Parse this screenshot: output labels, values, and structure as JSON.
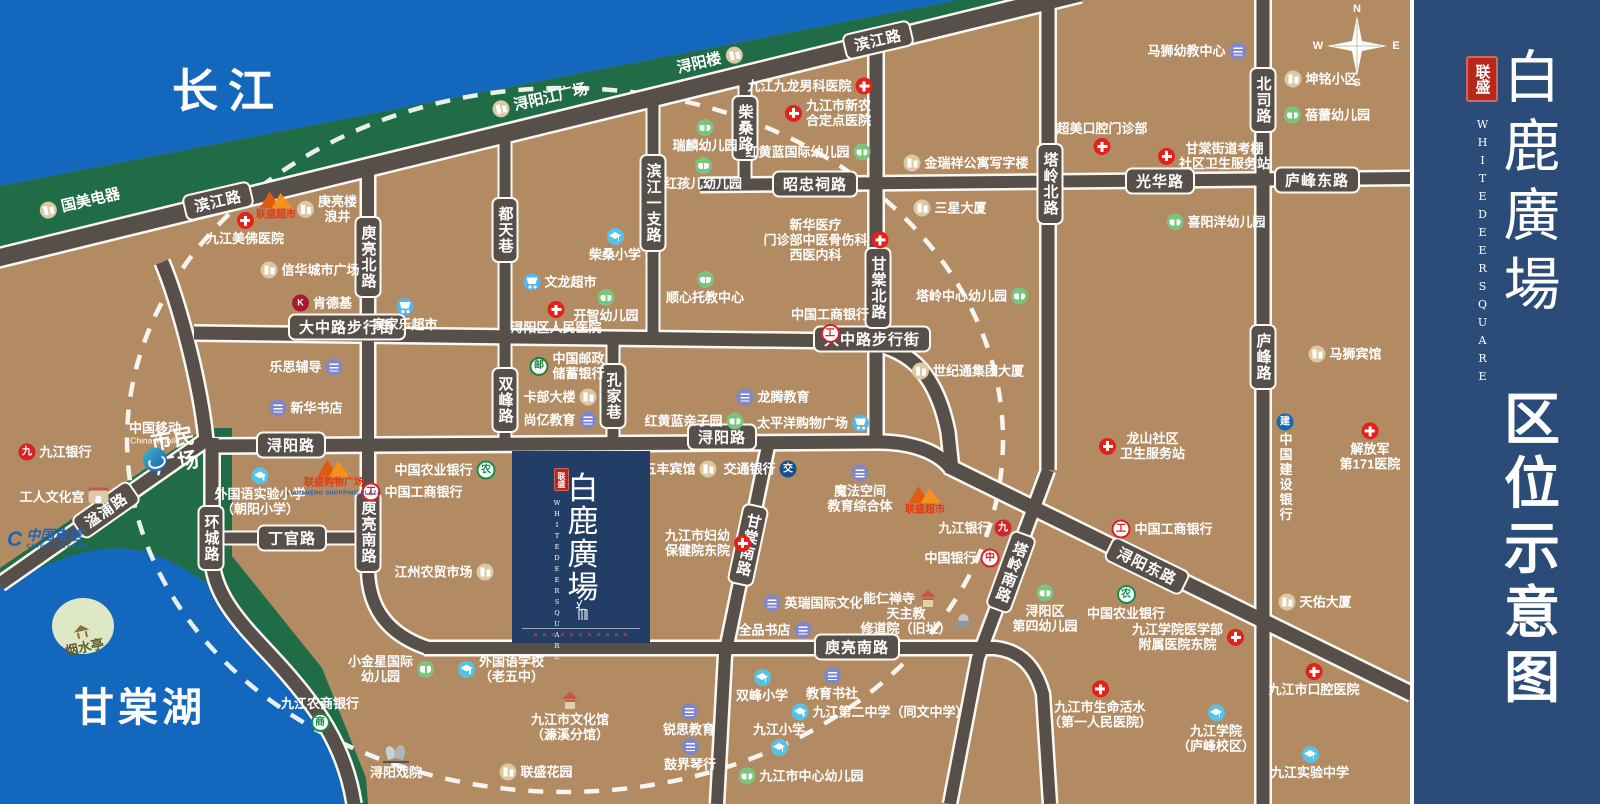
{
  "banner": {
    "seal": "联盛",
    "title": "白鹿廣場",
    "subtitle": "WHITEDEERSQUARE",
    "caption": "区位示意图"
  },
  "project": {
    "seal": "联盛",
    "title": "白鹿廣場",
    "subtitle": "WHITEDEERSQUARE"
  },
  "areas": {
    "river": "长江",
    "lake": "甘棠湖",
    "plaza_l1": "市民",
    "plaza_l2": "广场"
  },
  "compass": {
    "n": "N",
    "e": "E",
    "s": "S",
    "w": "W"
  },
  "colors": {
    "land": "#B38B63",
    "water": "#1367BC",
    "green": "#1F6C46",
    "road": "#57504A",
    "banner": "#2B4B78",
    "block": "#233E66",
    "seal_red": "#B6281C",
    "hospital": "#E32119",
    "school": "#55C3E8",
    "kindergarten": "#79C57E",
    "education": "#7E87CC",
    "market": "#57B6E9",
    "building": "#DBC9A3"
  },
  "icon_glyphs": {
    "icbc": "工",
    "boc": "中",
    "abc": "农",
    "psbc": "邮",
    "rcb": "商",
    "jjb": "九",
    "bocom": "交",
    "ccb": "建",
    "kfc": "K"
  },
  "band_labels": [
    {
      "t": "国美电器",
      "x": 80,
      "y": 203,
      "icon": "bldg",
      "side": "left",
      "rot": -13
    },
    {
      "t": "浔阳江广场",
      "x": 540,
      "y": 100,
      "icon": "bldg",
      "side": "left",
      "rot": -13
    },
    {
      "t": "浔阳楼",
      "x": 710,
      "y": 61,
      "icon": "bldg",
      "side": "right",
      "rot": -13
    }
  ],
  "road_labels": [
    {
      "t": "滨江路",
      "x": 218,
      "y": 201,
      "rot": -13
    },
    {
      "t": "滨江路",
      "x": 878,
      "y": 40,
      "rot": -13
    },
    {
      "t": "大中路步行街",
      "x": 347,
      "y": 327
    },
    {
      "t": "大中路步行街",
      "x": 872,
      "y": 339
    },
    {
      "t": "浔阳路",
      "x": 291,
      "y": 445
    },
    {
      "t": "浔阳路",
      "x": 722,
      "y": 437
    },
    {
      "t": "丁官路",
      "x": 292,
      "y": 538
    },
    {
      "t": "环城路",
      "x": 211,
      "y": 538,
      "v": true
    },
    {
      "t": "湓浦路",
      "x": 106,
      "y": 510,
      "rot": -35
    },
    {
      "t": "庾亮北路",
      "x": 368,
      "y": 257,
      "v": true
    },
    {
      "t": "庾亮南路",
      "x": 368,
      "y": 532,
      "v": true
    },
    {
      "t": "庾亮南路",
      "x": 857,
      "y": 647
    },
    {
      "t": "都天巷",
      "x": 505,
      "y": 230,
      "v": true
    },
    {
      "t": "双峰路",
      "x": 505,
      "y": 400,
      "v": true
    },
    {
      "t": "孔家巷",
      "x": 613,
      "y": 396,
      "v": true
    },
    {
      "t": "滨江一支路",
      "x": 653,
      "y": 203,
      "v": true
    },
    {
      "t": "柴桑路",
      "x": 745,
      "y": 128,
      "v": true
    },
    {
      "t": "甘棠北路",
      "x": 878,
      "y": 288,
      "v": true
    },
    {
      "t": "甘棠南路",
      "x": 748,
      "y": 545,
      "v": true,
      "rot": 12
    },
    {
      "t": "塔岭北路",
      "x": 1050,
      "y": 184,
      "v": true
    },
    {
      "t": "塔岭南路",
      "x": 1011,
      "y": 572,
      "v": true,
      "rot": 20
    },
    {
      "t": "昭忠祠路",
      "x": 815,
      "y": 184
    },
    {
      "t": "光华路",
      "x": 1160,
      "y": 181
    },
    {
      "t": "庐峰东路",
      "x": 1317,
      "y": 180
    },
    {
      "t": "北司路",
      "x": 1263,
      "y": 100,
      "v": true
    },
    {
      "t": "庐峰路",
      "x": 1263,
      "y": 357,
      "v": true
    },
    {
      "t": "浔阳东路",
      "x": 1147,
      "y": 566,
      "rot": 26
    }
  ],
  "pois": [
    {
      "t": "九江美佛医院",
      "x": 245,
      "y": 229,
      "icon": "hosp",
      "side": "top"
    },
    {
      "t": "九江九龙男科医院",
      "x": 810,
      "y": 86,
      "icon": "hosp",
      "side": "right"
    },
    {
      "t": "九江市新农\n合定点医院",
      "x": 828,
      "y": 113,
      "icon": "hosp",
      "side": "left"
    },
    {
      "t": "浔阳区人民医院",
      "x": 556,
      "y": 318,
      "icon": "hosp",
      "side": "top"
    },
    {
      "t": "新华医疗\n门诊部中医骨伤科\n西医内科",
      "x": 826,
      "y": 240,
      "icon": "hosp",
      "side": "right"
    },
    {
      "t": "超美口腔门诊部",
      "x": 1102,
      "y": 138,
      "icon": "hosp",
      "side": "bottom"
    },
    {
      "t": "甘棠街道考棚\n社区卫生服务站",
      "x": 1214,
      "y": 156,
      "icon": "hosp",
      "side": "left"
    },
    {
      "t": "龙山社区\n卫生服务站",
      "x": 1142,
      "y": 446,
      "icon": "hosp",
      "side": "left"
    },
    {
      "t": "解放军\n第171医院",
      "x": 1370,
      "y": 447,
      "icon": "hosp",
      "side": "top"
    },
    {
      "t": "九江市妇幼\n保健院东院",
      "x": 708,
      "y": 543,
      "icon": "hosp",
      "side": "right"
    },
    {
      "t": "九江市生命活水\n（第一人民医院）",
      "x": 1100,
      "y": 705,
      "icon": "hosp",
      "side": "top"
    },
    {
      "t": "九江学院医学部\n附属医院东院",
      "x": 1188,
      "y": 637,
      "icon": "hosp",
      "side": "right"
    },
    {
      "t": "九江市口腔医院",
      "x": 1314,
      "y": 680,
      "icon": "hosp",
      "side": "top"
    },
    {
      "t": "柴桑小学",
      "x": 615,
      "y": 245,
      "icon": "school",
      "side": "top"
    },
    {
      "t": "外国语实验小学\n（朝阳小学）",
      "x": 260,
      "y": 492,
      "icon": "school",
      "side": "top"
    },
    {
      "t": "外国语学校\n（老五中）",
      "x": 501,
      "y": 669,
      "icon": "school",
      "side": "left"
    },
    {
      "t": "双峰小学",
      "x": 762,
      "y": 686,
      "icon": "school",
      "side": "top"
    },
    {
      "t": "九江第二中学（同文中学）",
      "x": 880,
      "y": 712,
      "icon": "school",
      "side": "left"
    },
    {
      "t": "九江小学",
      "x": 779,
      "y": 739,
      "icon": "school",
      "side": "bottom"
    },
    {
      "t": "九江学院\n（庐峰校区）",
      "x": 1216,
      "y": 729,
      "icon": "school",
      "side": "top"
    },
    {
      "t": "九江实验中学",
      "x": 1310,
      "y": 763,
      "icon": "school",
      "side": "top"
    },
    {
      "t": "瑞麟幼儿园",
      "x": 705,
      "y": 136,
      "icon": "kind",
      "side": "top"
    },
    {
      "t": "红孩儿幼儿园",
      "x": 703,
      "y": 174,
      "icon": "kind",
      "side": "top"
    },
    {
      "t": "红黄蓝国际幼儿园",
      "x": 808,
      "y": 152,
      "icon": "kind",
      "side": "right"
    },
    {
      "t": "顺心托教中心",
      "x": 705,
      "y": 288,
      "icon": "kind",
      "side": "top"
    },
    {
      "t": "开智幼儿园",
      "x": 606,
      "y": 306,
      "icon": "kind",
      "side": "top"
    },
    {
      "t": "红黄蓝亲子园",
      "x": 694,
      "y": 421,
      "icon": "kind",
      "side": "right"
    },
    {
      "t": "小金星国际\n幼儿园",
      "x": 391,
      "y": 669,
      "icon": "kind",
      "side": "right"
    },
    {
      "t": "九江市中心幼儿园",
      "x": 801,
      "y": 776,
      "icon": "kind",
      "side": "left"
    },
    {
      "t": "蓓蕾幼儿园",
      "x": 1327,
      "y": 115,
      "icon": "kind",
      "side": "left"
    },
    {
      "t": "喜阳洋幼儿园",
      "x": 1216,
      "y": 222,
      "icon": "kind",
      "side": "left"
    },
    {
      "t": "塔岭中心幼儿园",
      "x": 972,
      "y": 296,
      "icon": "kind",
      "side": "right"
    },
    {
      "t": "浔阳区\n第四幼儿园",
      "x": 1045,
      "y": 609,
      "icon": "kind",
      "side": "top"
    },
    {
      "t": "马狮幼教中心",
      "x": 1197,
      "y": 51,
      "icon": "edu",
      "side": "right"
    },
    {
      "t": "新华书店",
      "x": 306,
      "y": 408,
      "icon": "edu",
      "side": "left"
    },
    {
      "t": "乐思辅导",
      "x": 306,
      "y": 367,
      "icon": "edu",
      "side": "right"
    },
    {
      "t": "尚亿教育",
      "x": 560,
      "y": 420,
      "icon": "edu",
      "side": "right"
    },
    {
      "t": "龙腾教育",
      "x": 773,
      "y": 397,
      "icon": "edu",
      "side": "left"
    },
    {
      "t": "魔法空间\n教育综合体",
      "x": 860,
      "y": 489,
      "icon": "edu",
      "side": "top"
    },
    {
      "t": "英瑞国际文化",
      "x": 813,
      "y": 603,
      "icon": "edu",
      "side": "left"
    },
    {
      "t": "全品书店",
      "x": 775,
      "y": 630,
      "icon": "edu",
      "side": "right"
    },
    {
      "t": "教育书社",
      "x": 832,
      "y": 684,
      "icon": "edu",
      "side": "top"
    },
    {
      "t": "锐思教育",
      "x": 689,
      "y": 720,
      "icon": "edu",
      "side": "top"
    },
    {
      "t": "鼓界琴行",
      "x": 690,
      "y": 755,
      "icon": "edu",
      "side": "top"
    },
    {
      "t": "家家乐超市",
      "x": 405,
      "y": 315,
      "icon": "cart",
      "side": "top"
    },
    {
      "t": "文龙超市",
      "x": 560,
      "y": 282,
      "icon": "cart",
      "side": "left"
    },
    {
      "t": "太平洋购物广场",
      "x": 813,
      "y": 423,
      "icon": "cart",
      "side": "right"
    },
    {
      "t": "信华城市广场",
      "x": 310,
      "y": 270,
      "icon": "bldg",
      "side": "left"
    },
    {
      "t": "庚亮楼\n浪井",
      "x": 327,
      "y": 209,
      "icon": "bldg",
      "side": "left"
    },
    {
      "t": "金瑞祥公寓写字楼",
      "x": 966,
      "y": 163,
      "icon": "bldg",
      "side": "left"
    },
    {
      "t": "三星大厦",
      "x": 950,
      "y": 208,
      "icon": "bldg",
      "side": "left"
    },
    {
      "t": "坤铭小区",
      "x": 1321,
      "y": 79,
      "icon": "bldg",
      "side": "left"
    },
    {
      "t": "世纪通集团大厦",
      "x": 968,
      "y": 371,
      "icon": "bldg",
      "side": "left"
    },
    {
      "t": "五丰宾馆",
      "x": 680,
      "y": 469,
      "icon": "bldg",
      "side": "right"
    },
    {
      "t": "马狮宾馆",
      "x": 1345,
      "y": 354,
      "icon": "bldg",
      "side": "left"
    },
    {
      "t": "天佑大厦",
      "x": 1315,
      "y": 602,
      "icon": "bldg",
      "side": "left"
    },
    {
      "t": "江州农贸市场",
      "x": 444,
      "y": 572,
      "icon": "bldg",
      "side": "right"
    },
    {
      "t": "联盛花园",
      "x": 536,
      "y": 772,
      "icon": "bldg",
      "side": "left"
    },
    {
      "t": "卡部大楼",
      "x": 560,
      "y": 397,
      "icon": "bldg",
      "side": "right"
    },
    {
      "t": "工人文化宫",
      "x": 64,
      "y": 497,
      "icon": "gate",
      "side": "right"
    },
    {
      "t": "中国工商银行",
      "x": 830,
      "y": 325,
      "icon": "icbc",
      "side": "bottom"
    },
    {
      "t": "中国工商银行",
      "x": 412,
      "y": 492,
      "icon": "icbc",
      "side": "left"
    },
    {
      "t": "中国工商银行",
      "x": 1162,
      "y": 529,
      "icon": "icbc",
      "side": "left"
    },
    {
      "t": "中国农业银行",
      "x": 445,
      "y": 470,
      "icon": "abc",
      "side": "right"
    },
    {
      "t": "中国农业银行",
      "x": 1126,
      "y": 603,
      "icon": "abc",
      "side": "top"
    },
    {
      "t": "九江银行",
      "x": 55,
      "y": 452,
      "icon": "jjb",
      "side": "left"
    },
    {
      "t": "九江银行",
      "x": 975,
      "y": 528,
      "icon": "jjb",
      "side": "right"
    },
    {
      "t": "中国银行",
      "x": 962,
      "y": 558,
      "icon": "boc",
      "side": "right"
    },
    {
      "t": "交通银行",
      "x": 760,
      "y": 469,
      "icon": "bocom",
      "side": "right"
    },
    {
      "t": "中国建设银行",
      "x": 1285,
      "y": 468,
      "icon": "ccb",
      "side": "top",
      "vert": true
    },
    {
      "t": "中国邮政\n储蓄银行",
      "x": 567,
      "y": 366,
      "icon": "psbc",
      "side": "left"
    },
    {
      "t": "九江农商银行",
      "x": 320,
      "y": 714,
      "icon": "rcb",
      "side": "bottom"
    },
    {
      "t": "肯德基",
      "x": 322,
      "y": 303,
      "icon": "kfc",
      "side": "left"
    },
    {
      "t": "联盛超市",
      "x": 276,
      "y": 205,
      "icon": "ls"
    },
    {
      "t": "联盛购物广场",
      "sub": "LIANSHENG SHOPPING PLAZA",
      "x": 334,
      "y": 477,
      "icon": "ls"
    },
    {
      "t": "联盛超市",
      "x": 925,
      "y": 500,
      "icon": "ls"
    },
    {
      "t": "中国移动",
      "sub": "China Mobile",
      "x": 155,
      "y": 446,
      "icon": "cmcc"
    },
    {
      "t": "中国电信",
      "sub": "CHINA TELECOM",
      "x": 48,
      "y": 539,
      "icon": "telecom"
    },
    {
      "t": "能仁禅寺",
      "x": 900,
      "y": 599,
      "icon": "pagoda",
      "side": "right"
    },
    {
      "t": "天主教\n修道院（旧址）",
      "x": 916,
      "y": 621,
      "icon": "temple",
      "side": "right"
    },
    {
      "t": "九江市文化馆\n（濂溪分馆）",
      "x": 570,
      "y": 717,
      "icon": "pagoda",
      "side": "top"
    },
    {
      "t": "浔阳戏院",
      "x": 396,
      "y": 762,
      "icon": "opera",
      "side": "top"
    },
    {
      "t": "烟水亭",
      "x": 83,
      "y": 640,
      "icon": "pav",
      "side": "top",
      "rot": -12,
      "dark": true
    }
  ]
}
